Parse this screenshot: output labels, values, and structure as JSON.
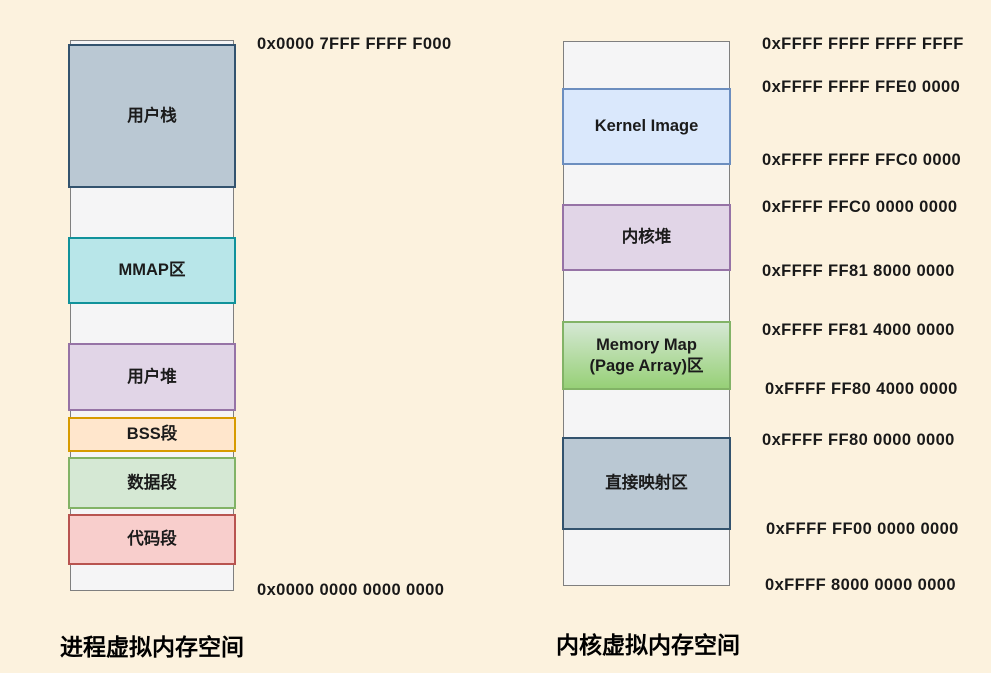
{
  "process_space": {
    "title": "进程虚拟内存空间",
    "top_address": "0x0000 7FFF FFFF F000",
    "bottom_address": "0x0000 0000 0000 0000",
    "segments": [
      {
        "label": "用户栈",
        "colors": {
          "fill": "#bac8d3",
          "stroke": "#33536e"
        }
      },
      {
        "label": "MMAP区",
        "colors": {
          "fill": "#b8e6e9",
          "stroke": "#10929b"
        }
      },
      {
        "label": "用户堆",
        "colors": {
          "fill": "#e1d5e7",
          "stroke": "#9673a6"
        }
      },
      {
        "label": "BSS段",
        "colors": {
          "fill": "#ffe6cc",
          "stroke": "#d79b00"
        }
      },
      {
        "label": "数据段",
        "colors": {
          "fill": "#d5e8d4",
          "stroke": "#82b366"
        }
      },
      {
        "label": "代码段",
        "colors": {
          "fill": "#f8cecc",
          "stroke": "#b85450"
        }
      }
    ]
  },
  "kernel_space": {
    "title": "内核虚拟内存空间",
    "segments": [
      {
        "label": "Kernel Image",
        "colors": {
          "fill": "#dae8fc",
          "stroke": "#6c8ebf"
        }
      },
      {
        "label": "内核堆",
        "colors": {
          "fill": "#e1d5e7",
          "stroke": "#9673a6"
        }
      },
      {
        "label": "Memory Map\n(Page Array)区",
        "colors": {
          "fill": "#d5e8d4",
          "fill2": "#97d077",
          "stroke": "#82b366"
        }
      },
      {
        "label": "直接映射区",
        "colors": {
          "fill": "#bac8d3",
          "stroke": "#33536e"
        }
      }
    ],
    "addresses": [
      "0xFFFF FFFF FFFF FFFF",
      "0xFFFF FFFF FFE0 0000",
      "0xFFFF FFFF FFC0 0000",
      "0xFFFF FFC0 0000 0000",
      "0xFFFF FF81 8000 0000",
      "0xFFFF FF81 4000 0000",
      "0xFFFF FF80 4000 0000",
      "0xFFFF FF80 0000 0000",
      "0xFFFF FF00 0000 0000",
      "0xFFFF 8000 0000 0000"
    ]
  }
}
